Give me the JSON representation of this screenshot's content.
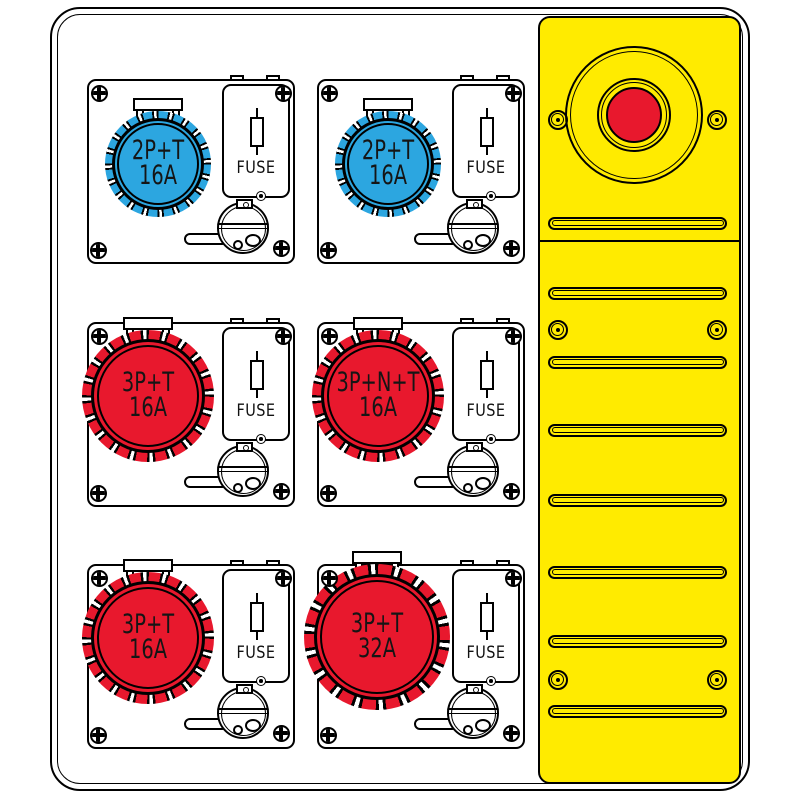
{
  "colors": {
    "socket_blue": "#2CA6E0",
    "socket_red": "#E8182D",
    "estop_red": "#E8182D",
    "panel_yellow": "#FFEB00",
    "outline": "#000000"
  },
  "units": [
    {
      "label_line1": "2P+T",
      "label_line2": "16A",
      "fuse_label": "FUSE",
      "socket_color": "#2CA6E0"
    },
    {
      "label_line1": "2P+T",
      "label_line2": "16A",
      "fuse_label": "FUSE",
      "socket_color": "#2CA6E0"
    },
    {
      "label_line1": "3P+T",
      "label_line2": "16A",
      "fuse_label": "FUSE",
      "socket_color": "#E8182D"
    },
    {
      "label_line1": "3P+N+T",
      "label_line2": "16A",
      "fuse_label": "FUSE",
      "socket_color": "#E8182D"
    },
    {
      "label_line1": "3P+T",
      "label_line2": "16A",
      "fuse_label": "FUSE",
      "socket_color": "#E8182D"
    },
    {
      "label_line1": "3P+T",
      "label_line2": "32A",
      "fuse_label": "FUSE",
      "socket_color": "#E8182D"
    }
  ],
  "side_panel": {
    "vent_slot_count": "8"
  }
}
